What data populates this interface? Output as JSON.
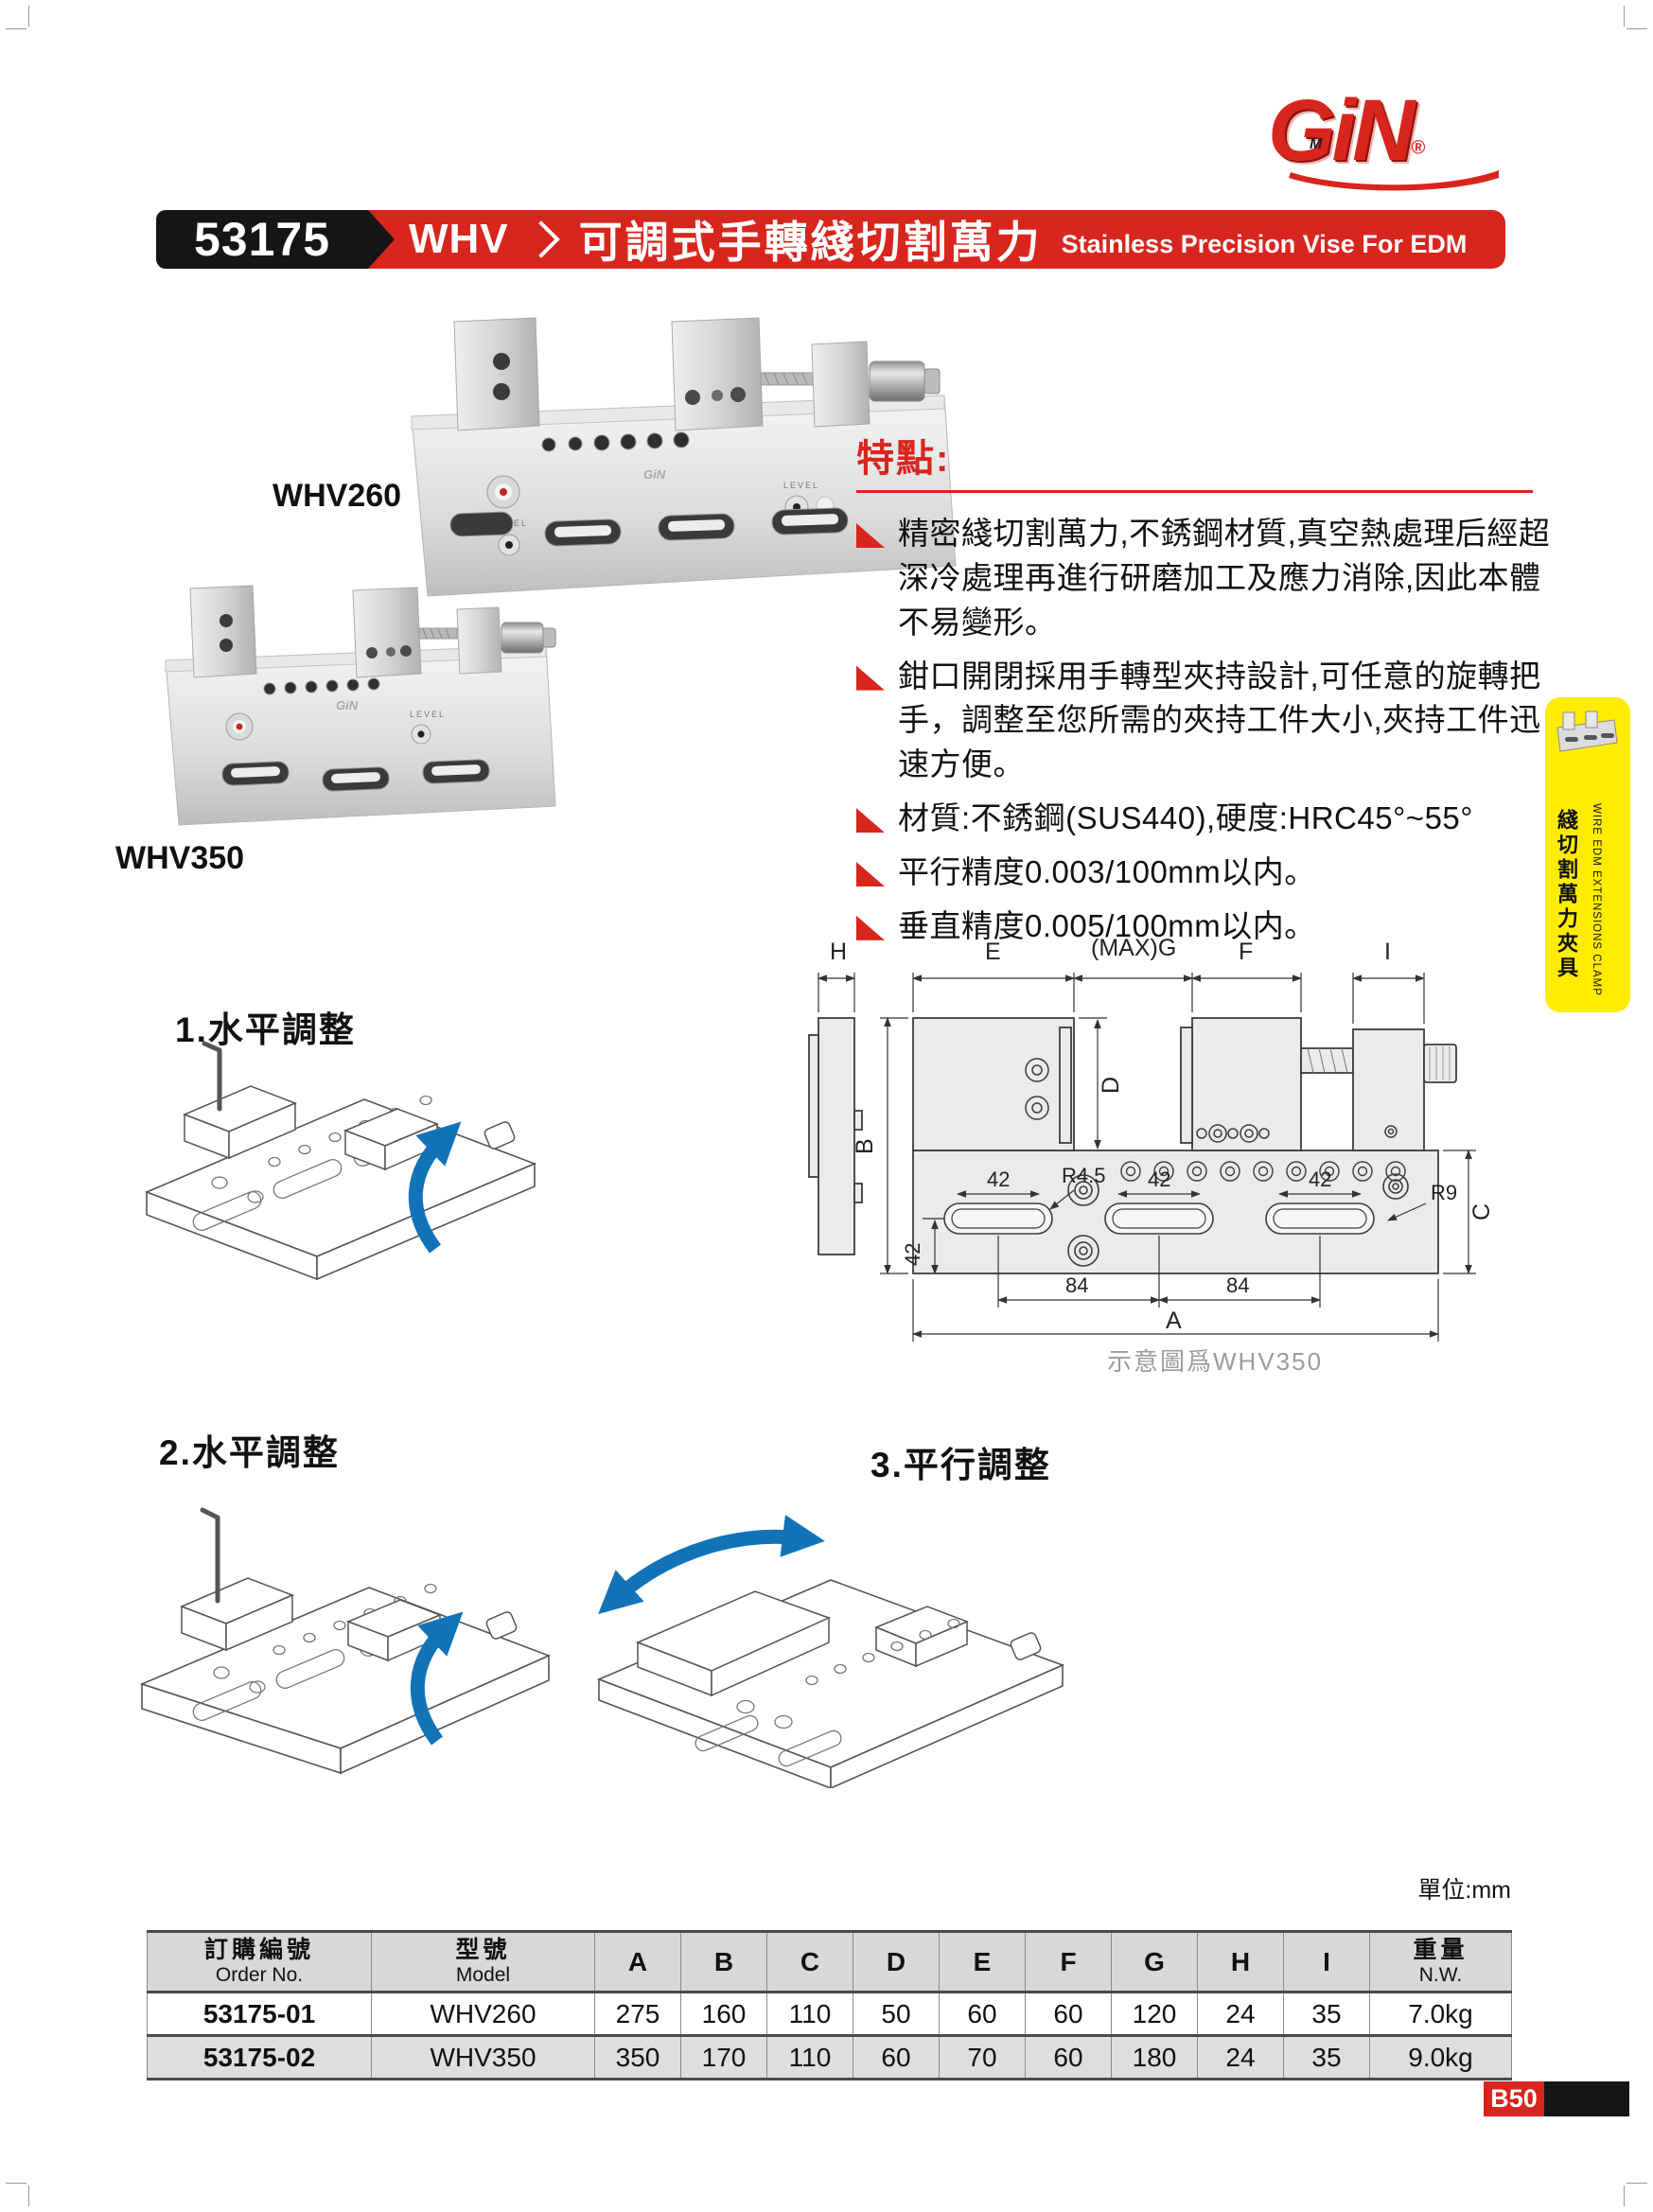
{
  "logo": {
    "brand": "GiN",
    "reg": "®",
    "mark": "M"
  },
  "header": {
    "code": "53175",
    "series": "WHV",
    "title_zh": "可調式手轉綫切割萬力",
    "title_en": "Stainless Precision Vise For EDM"
  },
  "photos": {
    "p1_label": "WHV260",
    "p2_label": "WHV350",
    "level_label": "LEVEL"
  },
  "features": {
    "heading": "特點:",
    "items": [
      "精密綫切割萬力,不銹鋼材質,真空熱處理后經超深冷處理再進行研磨加工及應力消除,因此本體不易變形。",
      "鉗口開閉採用手轉型夾持設計,可任意的旋轉把手，調整至您所需的夾持工件大小,夾持工件迅速方便。",
      "材質:不銹鋼(SUS440),硬度:HRC45°~55°",
      "平行精度0.003/100mm以内。",
      "垂直精度0.005/100mm以内。"
    ]
  },
  "side_tab": {
    "en": "WIRE EDM EXTENSIONS CLAMP",
    "zh": "綫切割萬力夾具"
  },
  "sections": [
    {
      "label": "1.水平調整"
    },
    {
      "label": "2.水平調整"
    },
    {
      "label": "3.平行調整"
    }
  ],
  "drawing": {
    "h": "H",
    "e": "E",
    "maxg": "(MAX)G",
    "f": "F",
    "i": "I",
    "b": "B",
    "d": "D",
    "c": "C",
    "a": "A",
    "dim42a": "42",
    "r45": "R4.5",
    "dim42b": "42",
    "dim42c": "42",
    "r9": "R9",
    "dim42v": "42",
    "dim84a": "84",
    "dim84b": "84",
    "caption": "示意圖爲WHV350"
  },
  "unit_label": "單位:mm",
  "table": {
    "col_order": {
      "zh": "訂購編號",
      "en": "Order No."
    },
    "col_model": {
      "zh": "型號",
      "en": "Model"
    },
    "dim_headers": [
      "A",
      "B",
      "C",
      "D",
      "E",
      "F",
      "G",
      "H",
      "I"
    ],
    "col_weight": {
      "zh": "重量",
      "en": "N.W."
    },
    "rows": [
      {
        "order": "53175-01",
        "model": "WHV260",
        "dims": [
          "275",
          "160",
          "110",
          "50",
          "60",
          "60",
          "120",
          "24",
          "35"
        ],
        "weight": "7.0kg"
      },
      {
        "order": "53175-02",
        "model": "WHV350",
        "dims": [
          "350",
          "170",
          "110",
          "60",
          "70",
          "60",
          "180",
          "24",
          "35"
        ],
        "weight": "9.0kg"
      }
    ]
  },
  "page_badge": "B50"
}
